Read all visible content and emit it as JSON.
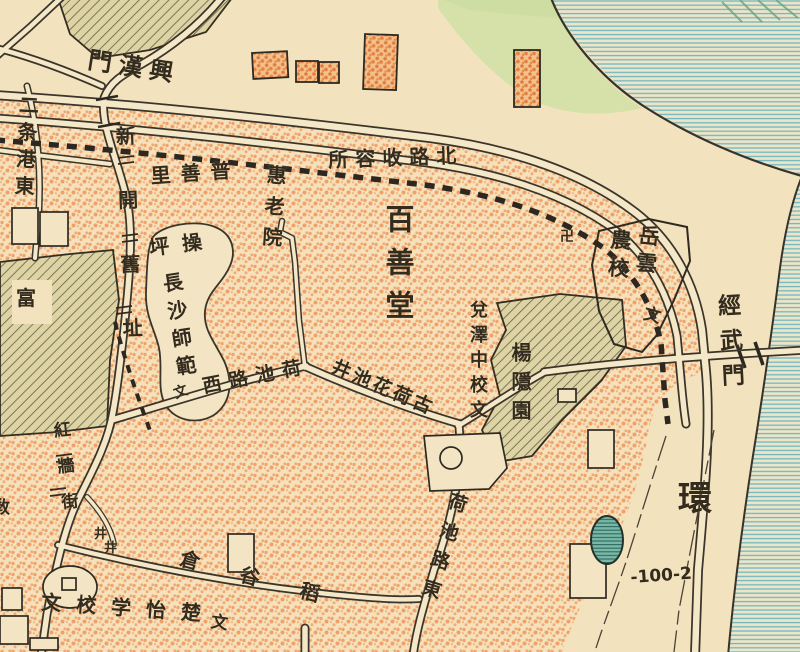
{
  "map": {
    "kind": "historical-city-street-map",
    "language": "zh-Hant",
    "colors": {
      "paper": "#f5e2bc",
      "urban_stipple": "#ee8a4d",
      "ink": "#322b1e",
      "water_line": "#72b7c0",
      "hatch_block": "#6a6749",
      "greenery": "#cde1a3",
      "pond": "#79b7a6"
    },
    "elevation_point": "-100-2",
    "labels": [
      {
        "name": "gate-xinghanmen",
        "text": "興漢門",
        "display_rtl": true,
        "x": 90,
        "y": 48,
        "size": 24,
        "orient": "h",
        "rotate": 9,
        "spacing": 7
      },
      {
        "name": "north-road-shelter",
        "text": "北路收容所",
        "display_rtl": true,
        "x": 328,
        "y": 150,
        "size": 20,
        "orient": "h",
        "rotate": -2,
        "spacing": 7
      },
      {
        "name": "ertiaogang-east",
        "text": "二条港東",
        "x": 18,
        "y": 94,
        "size": 20,
        "orient": "v",
        "spacing": 7,
        "rotate": 3
      },
      {
        "name": "xinkai-old-site",
        "text": "新開舊址",
        "x": 114,
        "y": 126,
        "size": 20,
        "orient": "v",
        "spacing": 44,
        "rotate": -2
      },
      {
        "name": "pushan-li",
        "text": "普善里",
        "display_rtl": true,
        "x": 150,
        "y": 166,
        "size": 20,
        "orient": "h",
        "rotate": -4,
        "spacing": 10
      },
      {
        "name": "huilao-yuan",
        "text": "惠老院",
        "x": 266,
        "y": 164,
        "size": 20,
        "orient": "v",
        "spacing": 11,
        "rotate": 4
      },
      {
        "name": "drill-ground-caoping",
        "text": "操坪",
        "display_rtl": true,
        "x": 148,
        "y": 238,
        "size": 20,
        "orient": "h",
        "rotate": -7,
        "spacing": 13
      },
      {
        "name": "changsha-normal-school",
        "text": "長沙師範",
        "x": 160,
        "y": 274,
        "size": 20,
        "orient": "v",
        "spacing": 8,
        "rotate": -9
      },
      {
        "name": "school-symbol-changsha-normal",
        "text": "文",
        "x": 172,
        "y": 388,
        "size": 14,
        "orient": "h",
        "rotate": -20
      },
      {
        "name": "baishan-tang",
        "text": "百善堂",
        "x": 383,
        "y": 204,
        "size": 29,
        "orient": "v",
        "spacing": 14,
        "weight": 700
      },
      {
        "name": "hechi-road-west",
        "text": "荷池路西",
        "display_rtl": true,
        "x": 201,
        "y": 378,
        "size": 19,
        "orient": "h",
        "rotate": -11,
        "spacing": 8
      },
      {
        "name": "old-lotus-pond-well",
        "text": "古荷花池井",
        "display_rtl": true,
        "x": 336,
        "y": 358,
        "size": 19,
        "orient": "h",
        "rotate": 23,
        "spacing": 3
      },
      {
        "name": "duize-middle-school",
        "text": "兌澤中校文",
        "x": 468,
        "y": 300,
        "size": 18,
        "orient": "v",
        "spacing": 7
      },
      {
        "name": "yangyin-garden",
        "text": "楊隱園",
        "x": 510,
        "y": 342,
        "size": 20,
        "orient": "v",
        "spacing": 9
      },
      {
        "name": "yueyun-school-col-right",
        "text": "岳雲",
        "x": 638,
        "y": 224,
        "size": 21,
        "orient": "v",
        "spacing": 6,
        "rotate": 5
      },
      {
        "name": "yueyun-school-col-left",
        "text": "農校",
        "x": 610,
        "y": 228,
        "size": 21,
        "orient": "v",
        "spacing": 7,
        "rotate": 5
      },
      {
        "name": "school-symbol-yueyun",
        "text": "文",
        "x": 646,
        "y": 306,
        "size": 17,
        "orient": "h",
        "rotate": 15
      },
      {
        "name": "swastika-temple-mark",
        "text": "卍",
        "x": 560,
        "y": 230,
        "size": 14,
        "orient": "h"
      },
      {
        "name": "gate-jingwumen",
        "text": "經武門",
        "x": 714,
        "y": 294,
        "size": 23,
        "orient": "v",
        "spacing": 12,
        "rotate": -3
      },
      {
        "name": "ring-road-huan",
        "text": "環",
        "x": 678,
        "y": 482,
        "size": 34,
        "orient": "h",
        "weight": 700
      },
      {
        "name": "hechi-road-east",
        "text": "荷池路東",
        "x": 450,
        "y": 490,
        "size": 19,
        "orient": "v",
        "spacing": 11,
        "rotate": 17
      },
      {
        "name": "rice-granary",
        "text": "稻谷倉",
        "display_rtl": true,
        "x": 183,
        "y": 548,
        "size": 20,
        "orient": "h",
        "rotate": 15,
        "spacing": 42
      },
      {
        "name": "chuyi-school",
        "text": "楚怡学校文",
        "display_rtl": true,
        "x": 42,
        "y": 592,
        "size": 20,
        "orient": "h",
        "rotate": 4,
        "spacing": 15
      },
      {
        "name": "hongqiang-street",
        "text": "紅牆街",
        "x": 50,
        "y": 422,
        "size": 17,
        "orient": "v",
        "spacing": 19,
        "rotate": -6
      },
      {
        "name": "well-symbol-1",
        "text": "井",
        "x": 94,
        "y": 528,
        "size": 13,
        "orient": "h"
      },
      {
        "name": "well-symbol-2",
        "text": "井",
        "x": 104,
        "y": 542,
        "size": 13,
        "orient": "h"
      },
      {
        "name": "elevation-point-label",
        "text": "-100-2",
        "x": 630,
        "y": 570,
        "size": 17,
        "orient": "h",
        "rotate": -4,
        "weight": 700
      },
      {
        "name": "fu-label",
        "text": "富",
        "x": 16,
        "y": 288,
        "size": 20,
        "orient": "h"
      },
      {
        "name": "partial-label-bottom",
        "text": "文",
        "x": 212,
        "y": 614,
        "size": 17,
        "orient": "h",
        "rotate": 8
      },
      {
        "name": "partial-label-left-edge",
        "text": "敎",
        "x": -7,
        "y": 500,
        "size": 17,
        "orient": "h"
      }
    ]
  }
}
